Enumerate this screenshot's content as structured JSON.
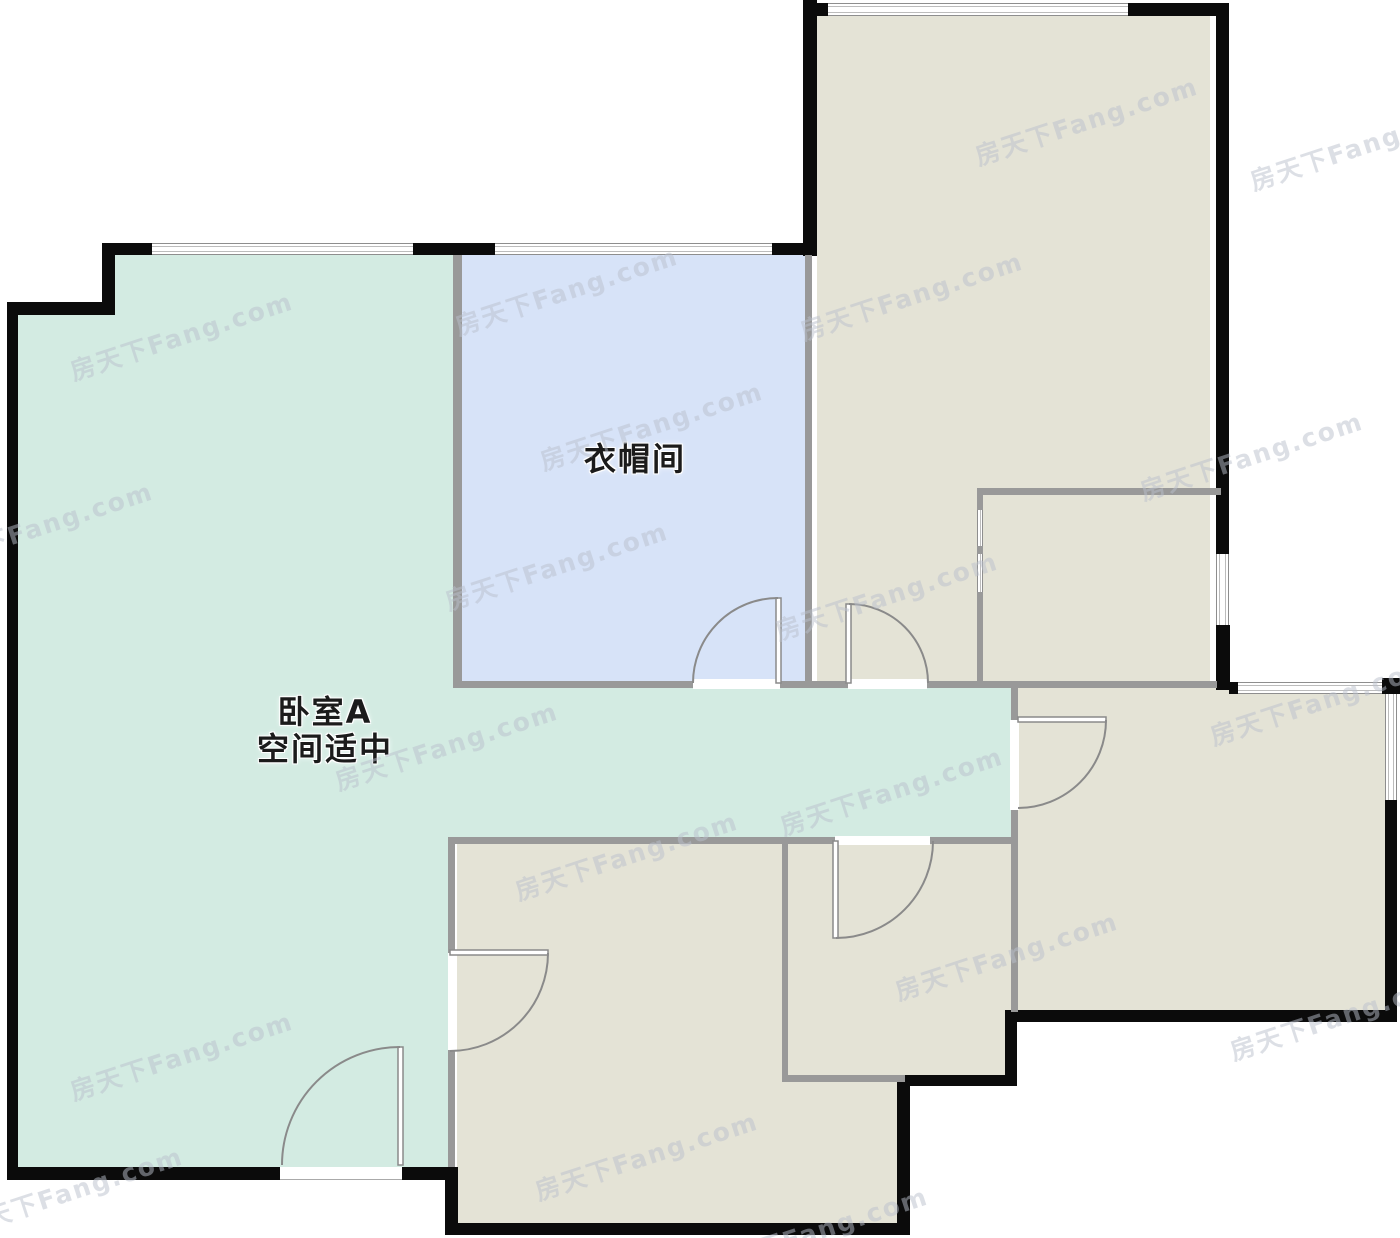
{
  "rooms": {
    "bedroom_a": {
      "name": "卧室A",
      "note": "空间适中"
    },
    "cloakroom": {
      "name": "衣帽间"
    }
  },
  "watermark": {
    "text": "房天下Fang.com"
  },
  "colors": {
    "bedroom-fill": "#d3ebe2",
    "cloakroom-fill": "#d7e3f8",
    "room-fill": "#e4e3d6",
    "wall-black": "#0b0b0b",
    "wall-gray": "#999999",
    "door-line": "#8a8a8a",
    "label-text": "#1b1b1b",
    "watermark-color": "rgba(186,192,204,0.5)"
  }
}
